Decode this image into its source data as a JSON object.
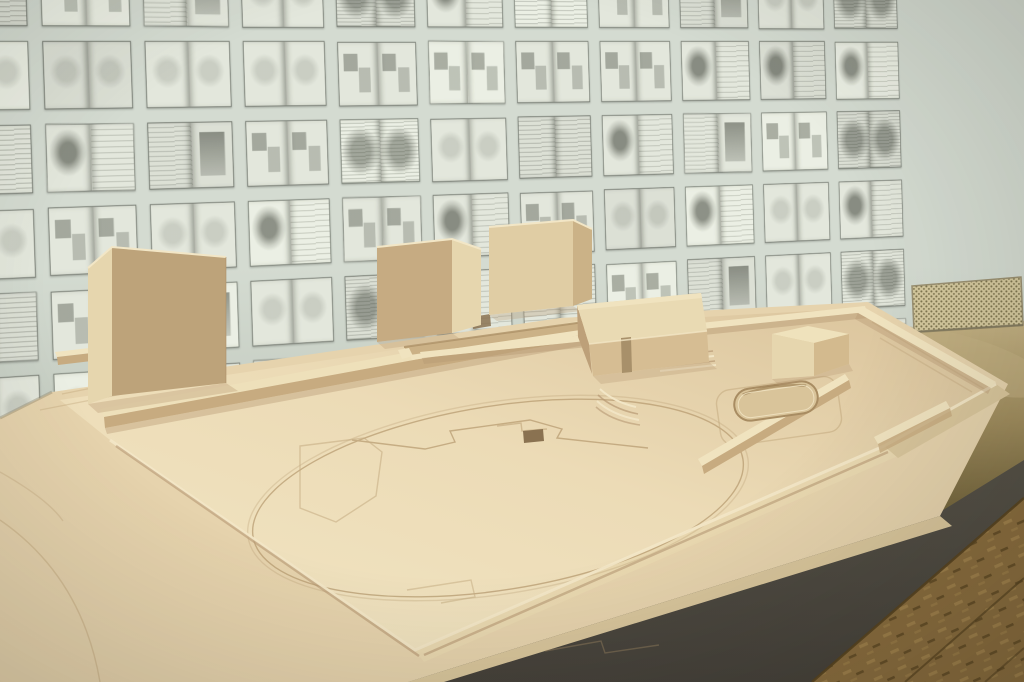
{
  "scene": {
    "description": "Photograph of a pale wooden architectural massing model on a table, set in front of a wall covered with a grid of pinned-open sketchbook spreads",
    "wall_label": "wall grid of open sketchbook pages with pencil sketches",
    "model_label": "pale wood site model with tower blocks, pavilion, sunken plaza and engraved circulation lines",
    "baseboard_label": "layered wooden base boards of the model",
    "plaza_label": "central plaza with engraved circle and routes",
    "blocks_label": "solid wooden building blocks",
    "pavilion_label": "low flat-roofed pavilion with entry slot and steps",
    "pool_label": "sunken stadium-shaped pool recess",
    "grille_label": "beige honeycomb ventilation grille at wall base",
    "table_label": "OSB chipboard table corner with dark front edge",
    "floor_label": "olive tabletop behind the model"
  },
  "wall": {
    "rows": 6,
    "cols": 11,
    "variants": 6
  },
  "palette": {
    "wall_bg": "#d4dbd1",
    "wall_bg_deep": "#c2cabf",
    "page": "#e3e7dc",
    "ink": "#565b4e",
    "plate_top_a": "#f2e6c4",
    "plate_top_b": "#ecdbb6",
    "plate_top_c": "#d9c29a",
    "plate_low": "#e6d3ad",
    "plate_side": "#e9d8b0",
    "plate_side_dark": "#d9c69c",
    "face_light": "#e6d6ae",
    "face_mid": "#d9c49a",
    "face_dark": "#bda37a",
    "face_top": "#f0e3bf",
    "wall_top": "#eee0ba",
    "wall_face": "#c7ab80",
    "ridge_light": "#f2e6c6",
    "engrave": "#b5996e",
    "hole_dark": "#8a7251",
    "shadow_warm": "#b69873",
    "trench": "#cbb186",
    "olive_light": "#c3b183",
    "olive": "#a08d5e",
    "olive_dark": "#6f6139",
    "edge_dark": "#555147",
    "edge_darker": "#45413a",
    "osb": "#8a6d3e",
    "osb_dark": "#57431f",
    "osb_light": "#a5874e",
    "grille": "#d3c79d",
    "grille_dot": "#7f7650"
  }
}
